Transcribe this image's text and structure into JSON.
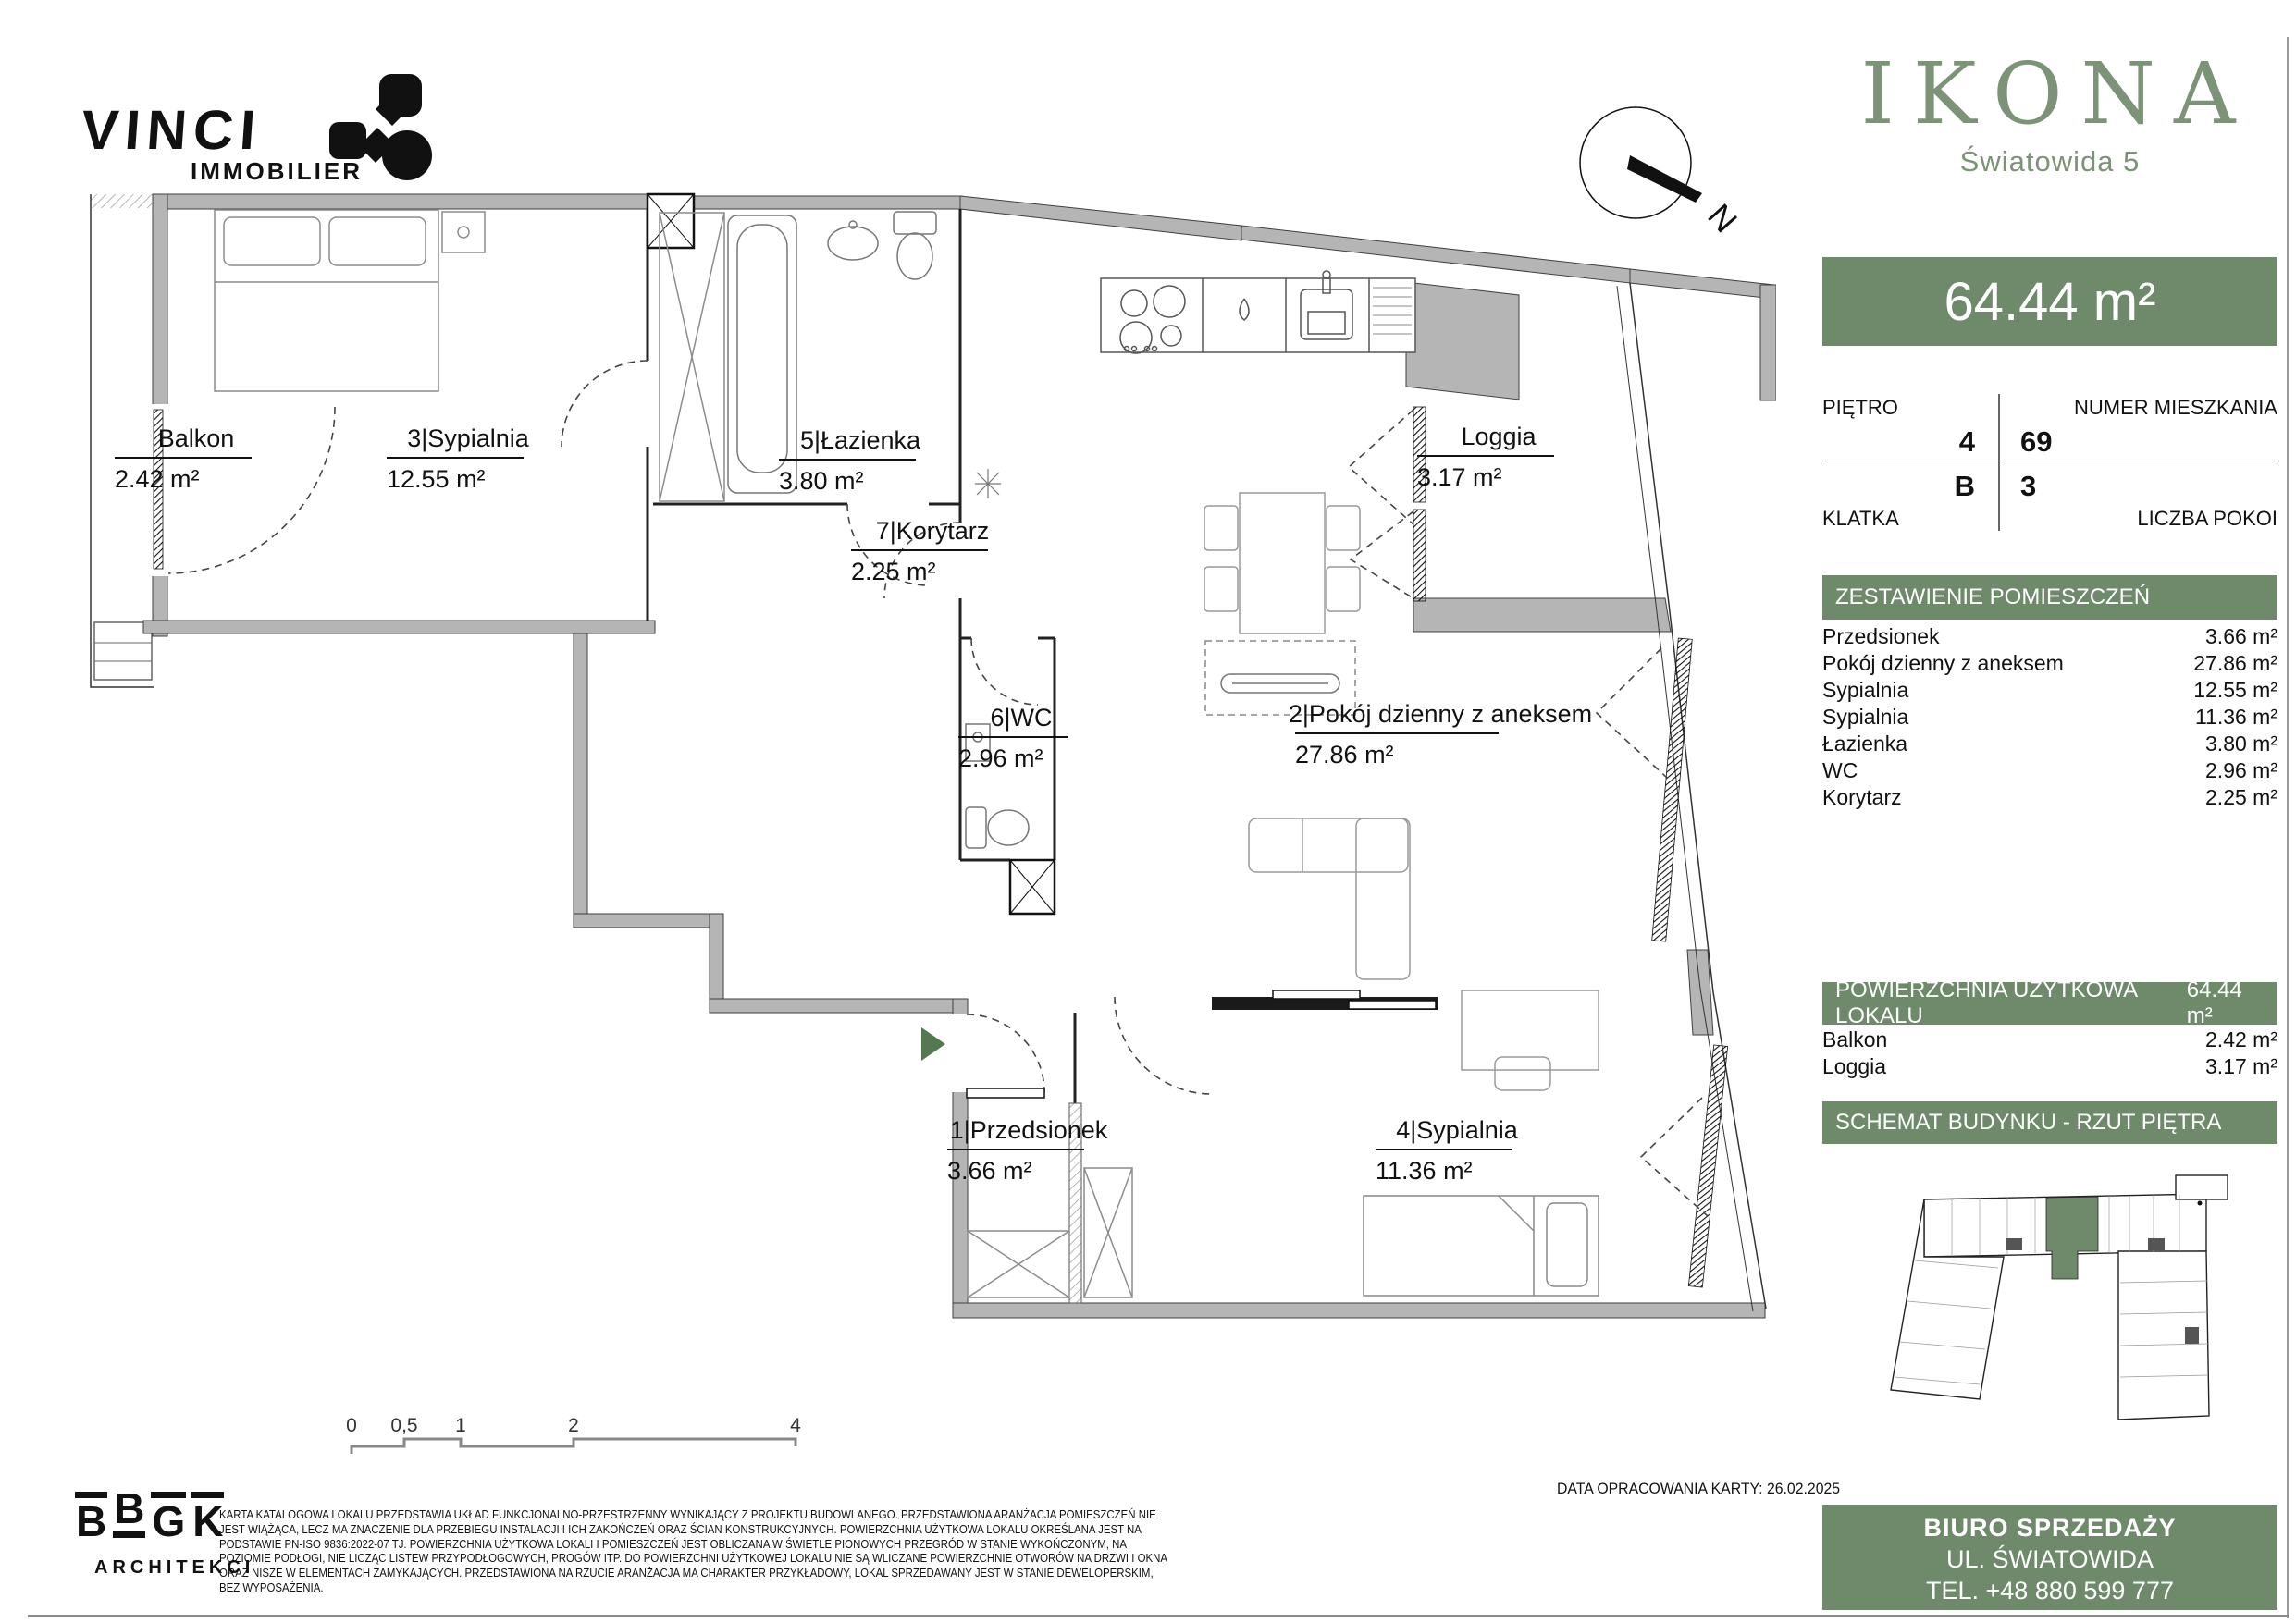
{
  "branding": {
    "developer": "VINCI",
    "developer_sub": "IMMOBILIER",
    "project": "IKONA",
    "address": "Światowida 5",
    "architect_letters": [
      "B",
      "B",
      "G",
      "K"
    ],
    "architect_sub": "ARCHITEKCI"
  },
  "compass": {
    "north_label": "N"
  },
  "summary": {
    "area_banner": "64.44 m²"
  },
  "unit_info": {
    "floor_label": "PIĘTRO",
    "floor_value": "4",
    "number_label": "NUMER MIESZKANIA",
    "number_value": "69",
    "staircase_label": "KLATKA",
    "staircase_value": "B",
    "rooms_label": "LICZBA POKOI",
    "rooms_value": "3"
  },
  "room_schedule": {
    "header": "ZESTAWIENIE POMIESZCZEŃ",
    "rows": [
      {
        "label": "Przedsionek",
        "value": "3.66 m²"
      },
      {
        "label": "Pokój dzienny z aneksem",
        "value": "27.86 m²"
      },
      {
        "label": "Sypialnia",
        "value": "12.55 m²"
      },
      {
        "label": "Sypialnia",
        "value": "11.36 m²"
      },
      {
        "label": "Łazienka",
        "value": "3.80 m²"
      },
      {
        "label": "WC",
        "value": "2.96 m²"
      },
      {
        "label": "Korytarz",
        "value": "2.25 m²"
      }
    ]
  },
  "usable_area": {
    "header": "POWIERZCHNIA UŻYTKOWA LOKALU",
    "value": "64.44 m²",
    "rows": [
      {
        "label": "Balkon",
        "value": "2.42 m²"
      },
      {
        "label": "Loggia",
        "value": "3.17 m²"
      }
    ]
  },
  "schematic": {
    "header": "SCHEMAT BUDYNKU - RZUT PIĘTRA"
  },
  "plan": {
    "rooms": [
      {
        "title": "Balkon",
        "area": "2.42 m²"
      },
      {
        "title": "3|Sypialnia",
        "area": "12.55 m²"
      },
      {
        "title": "5|Łazienka",
        "area": "3.80 m²"
      },
      {
        "title": "7|Korytarz",
        "area": "2.25 m²"
      },
      {
        "title": "6|WC",
        "area": "2.96 m²"
      },
      {
        "title": "2|Pokój dzienny z aneksem",
        "area": "27.86 m²"
      },
      {
        "title": "Loggia",
        "area": "3.17 m²"
      },
      {
        "title": "1|Przedsionek",
        "area": "3.66 m²"
      },
      {
        "title": "4|Sypialnia",
        "area": "11.36 m²"
      }
    ],
    "scale": {
      "labels": [
        "0",
        "0,5",
        "1",
        "2",
        "4"
      ]
    }
  },
  "footer": {
    "date": "DATA OPRACOWANIA KARTY: 26.02.2025",
    "disclaimer": "KARTA KATALOGOWA LOKALU PRZEDSTAWIA UKŁAD FUNKCJONALNO-PRZESTRZENNY WYNIKAJĄCY Z PROJEKTU BUDOWLANEGO. PRZEDSTAWIONA ARANŻACJA POMIESZCZEŃ NIE JEST WIĄŻĄCA, LECZ MA ZNACZENIE DLA PRZEBIEGU INSTALACJI I ICH ZAKOŃCZEŃ ORAZ ŚCIAN KONSTRUKCYJNYCH. POWIERZCHNIA UŻYTKOWA LOKALU OKREŚLANA JEST NA PODSTAWIE PN-ISO 9836:2022-07 TJ. POWIERZCHNIA UŻYTKOWA LOKALI I POMIESZCZEŃ JEST OBLICZANA W ŚWIETLE PIONOWYCH PRZEGRÓD W STANIE WYKOŃCZONYM, NA POZIOMIE PODŁOGI, NIE LICZĄC LISTEW PRZYPODŁOGOWYCH, PROGÓW ITP. DO POWIERZCHNI UŻYTKOWEJ LOKALU NIE SĄ WLICZANE POWIERZCHNIE OTWORÓW NA DRZWI I OKNA ORAZ NISZE W ELEMENTACH ZAMYKAJĄCYCH. PRZEDSTAWIONA NA RZUCIE ARANŻACJA MA CHARAKTER PRZYKŁADOWY, LOKAL SPRZEDAWANY JEST W STANIE DEWELOPERSKIM, BEZ WYPOSAŻENIA.",
    "office": {
      "line1": "BIURO SPRZEDAŻY",
      "line2": "UL. ŚWIATOWIDA",
      "line3": "TEL. +48 880 599 777"
    }
  },
  "colors": {
    "accent_green": "#6E8A6B",
    "logo_green": "#7C9377",
    "entrance_green": "#54784F",
    "wall_gray": "#B5B5B5"
  }
}
